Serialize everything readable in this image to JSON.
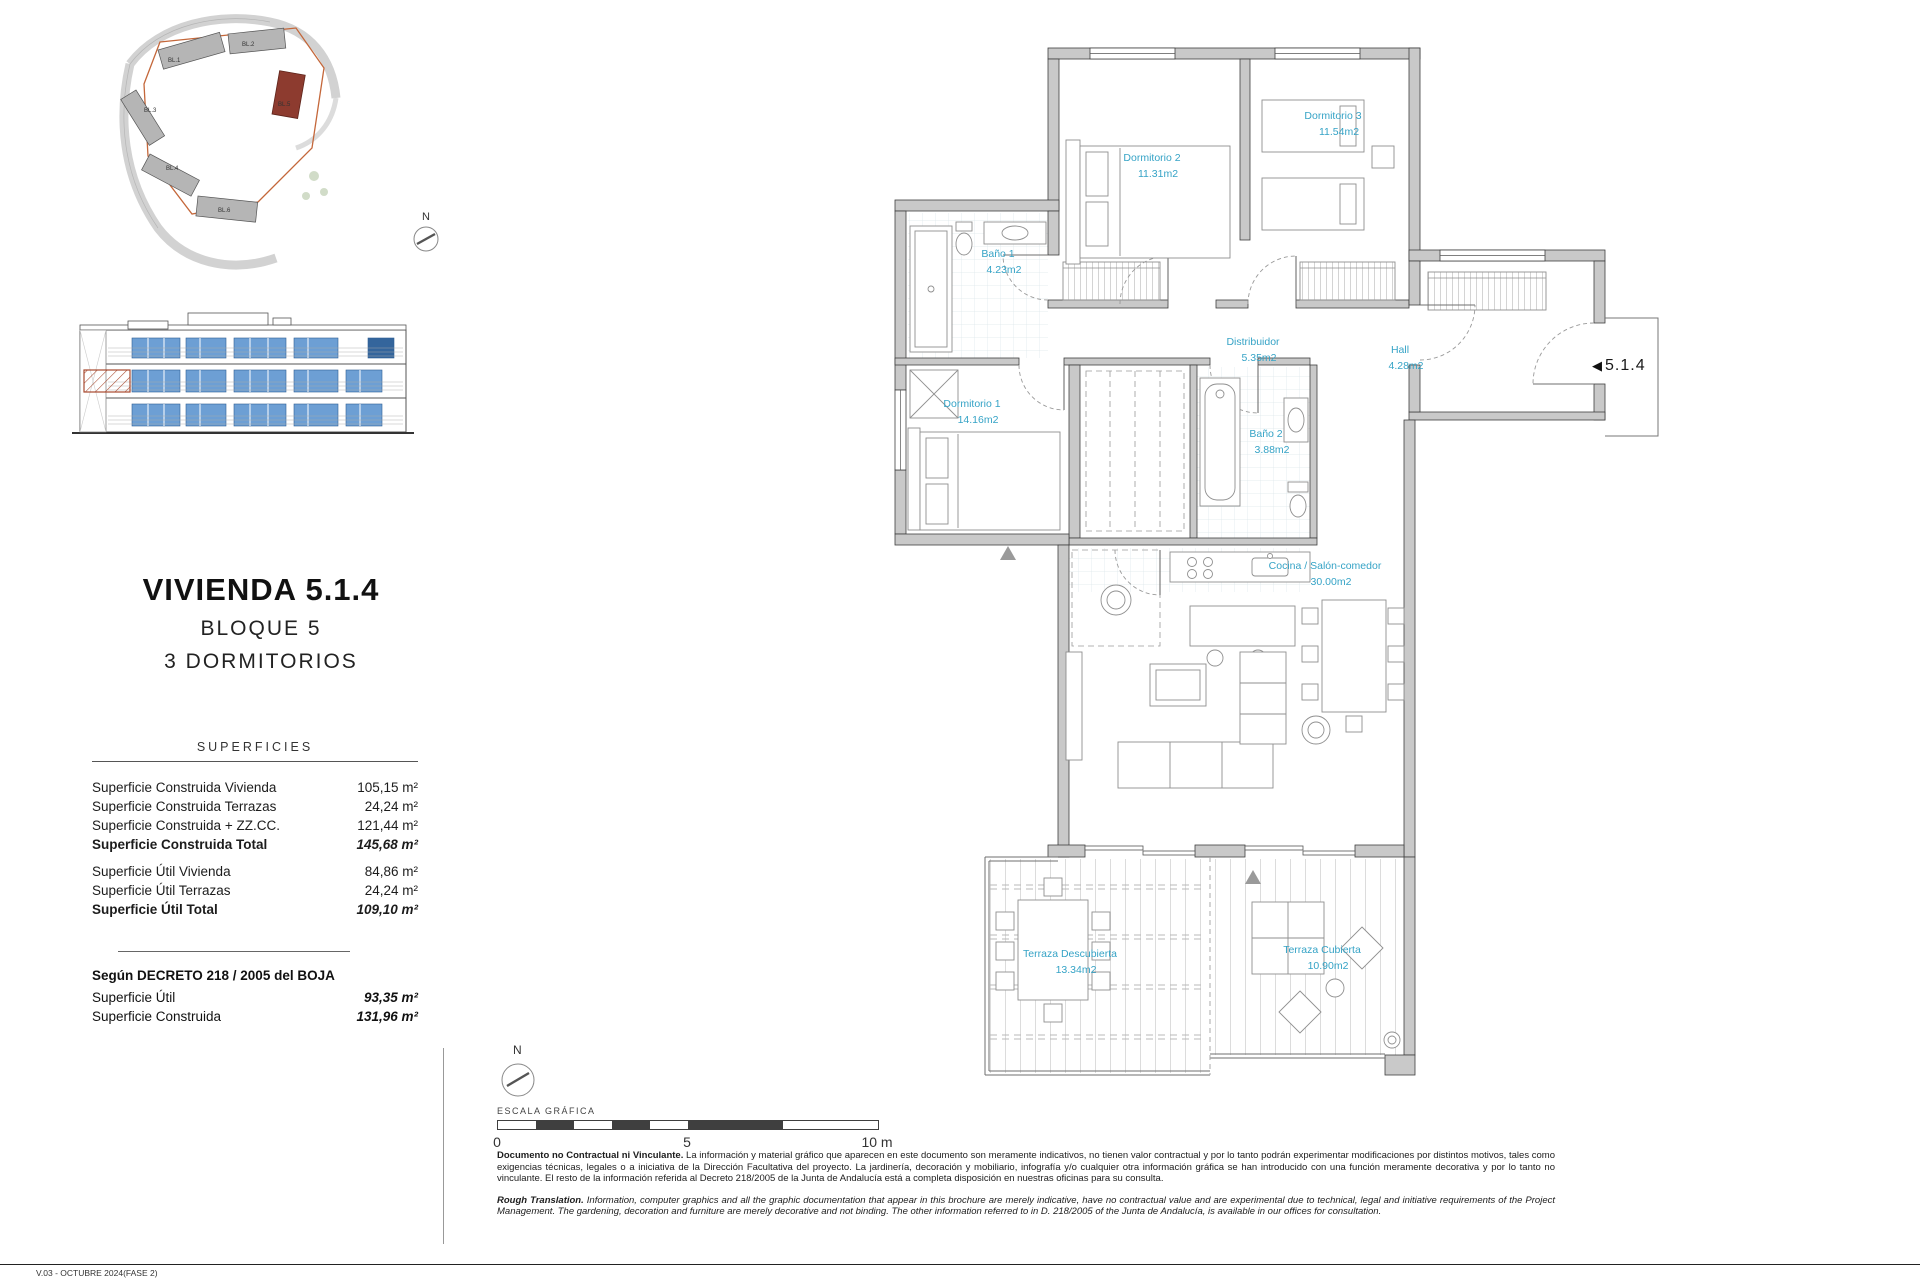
{
  "site": {
    "compass_label": "N",
    "blocks": [
      "BL.1",
      "BL.2",
      "BL.3",
      "BL.4",
      "BL.6",
      "BL.5"
    ]
  },
  "unit": {
    "title": "VIVIENDA 5.1.4",
    "block": "BLOQUE 5",
    "bedrooms": "3 DORMITORIOS",
    "marker": "5.1.4"
  },
  "surfaces": {
    "header": "SUPERFICIES",
    "rows": [
      {
        "label": "Superficie Construida Vivienda",
        "value": "105,15 m²"
      },
      {
        "label": "Superficie Construida Terrazas",
        "value": "24,24 m²"
      },
      {
        "label": "Superficie Construida + ZZ.CC.",
        "value": "121,44 m²"
      },
      {
        "label": "Superficie Construida Total",
        "value": "145,68 m²"
      },
      {
        "label": "Superficie Útil Vivienda",
        "value": "84,86 m²"
      },
      {
        "label": "Superficie Útil Terrazas",
        "value": "24,24 m²"
      },
      {
        "label": "Superficie Útil Total",
        "value": "109,10 m²"
      }
    ],
    "decree_header": "Según DECRETO 218 / 2005 del BOJA",
    "decree_rows": [
      {
        "label": "Superficie Útil",
        "value": "93,35 m²"
      },
      {
        "label": "Superficie Construida",
        "value": "131,96 m²"
      }
    ]
  },
  "plan": {
    "label_color": "#35a3c6",
    "rooms": [
      {
        "name": "Dormitorio 2",
        "area": "11.31m2"
      },
      {
        "name": "Dormitorio 3",
        "area": "11.54m2"
      },
      {
        "name": "Baño 1",
        "area": "4.23m2"
      },
      {
        "name": "Dormitorio 1",
        "area": "14.16m2"
      },
      {
        "name": "Baño 2",
        "area": "3.88m2"
      },
      {
        "name": "Distribuidor",
        "area": "5.35m2"
      },
      {
        "name": "Hall",
        "area": "4.28m2"
      },
      {
        "name": "Cocina / Salón-comedor",
        "area": "30.00m2"
      },
      {
        "name": "Terraza Descubierta",
        "area": "13.34m2"
      },
      {
        "name": "Terraza Cubierta",
        "area": "10.90m2"
      }
    ]
  },
  "scale": {
    "compass_label": "N",
    "label": "ESCALA GRÁFICA",
    "ticks": [
      "0",
      "5",
      "10 m"
    ]
  },
  "disclaimer": {
    "es_lead": "Documento no Contractual ni Vinculante.",
    "es_text": "La información y material gráfico que aparecen en este documento son meramente indicativos, no tienen valor contractual y por lo tanto podrán experimentar modificaciones por distintos motivos, tales como exigencias técnicas, legales o a iniciativa de la Dirección Facultativa del proyecto. La jardinería, decoración y mobiliario, infografía y/o cualquier otra información gráfica se han introducido con una función meramente decorativa y por lo tanto no vinculante. El resto de la información referida al Decreto 218/2005 de la Junta de Andalucía está a completa disposición en nuestras oficinas para su consulta.",
    "en_lead": "Rough Translation.",
    "en_text": "Information, computer graphics and all the graphic documentation that appear in this brochure are merely indicative, have no contractual value and are experimental due to technical, legal and initiative requirements of the Project Management. The gardening, decoration and furniture are merely decorative and not binding. The other information referred to in D. 218/2005 of the Junta de Andalucía, is available in our offices for consultation."
  },
  "footer": {
    "version": "V.03 - OCTUBRE 2024(FASE 2)"
  }
}
